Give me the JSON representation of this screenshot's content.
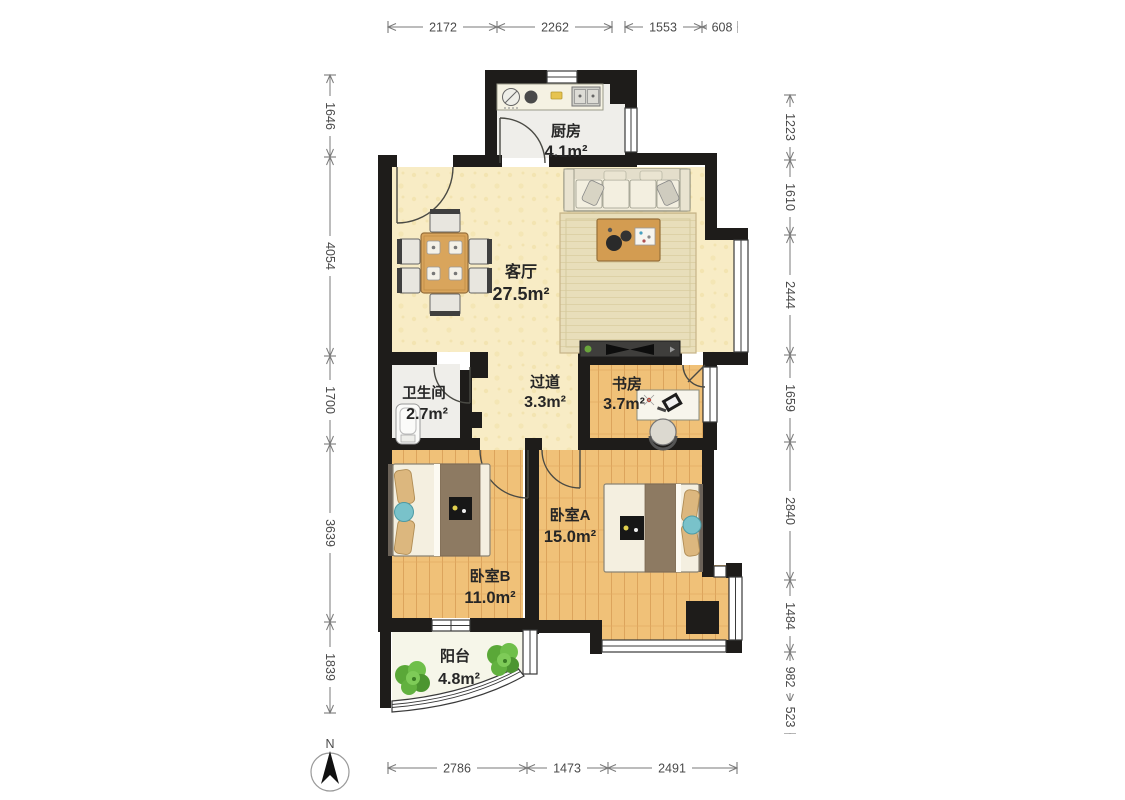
{
  "plan_title": "apartment-floor-plan",
  "rooms": {
    "kitchen": {
      "name": "厨房",
      "area": "4.1m²"
    },
    "living": {
      "name": "客厅",
      "area": "27.5m²"
    },
    "hallway": {
      "name": "过道",
      "area": "3.3m²"
    },
    "study": {
      "name": "书房",
      "area": "3.7m²"
    },
    "bathroom": {
      "name": "卫生间",
      "area": "2.7m²"
    },
    "bedroomA": {
      "name": "卧室A",
      "area": "15.0m²"
    },
    "bedroomB": {
      "name": "卧室B",
      "area": "11.0m²"
    },
    "balcony": {
      "name": "阳台",
      "area": "4.8m²"
    }
  },
  "dims": {
    "top": [
      "2172",
      "2262",
      "1553",
      "608"
    ],
    "left": [
      "1646",
      "4054",
      "1700",
      "3639",
      "1839"
    ],
    "right": [
      "1223",
      "1610",
      "2444",
      "1659",
      "2840",
      "1484",
      "982",
      "523"
    ],
    "bottom": [
      "2786",
      "1473",
      "2491"
    ]
  },
  "compass": {
    "label": "N"
  },
  "colors": {
    "wall": "#1e1c1a",
    "living_floor": "#f8ecc5",
    "wood_floor": "#f0c178",
    "tile_floor": "#efeeea",
    "balcony_floor": "#f6f6e9",
    "rug": "#e8deba",
    "bed_runner": "#8d7a62",
    "accent_teal": "#79c2ca",
    "plant_green": "#61b33e",
    "dimension_text": "#4a4a4a"
  }
}
